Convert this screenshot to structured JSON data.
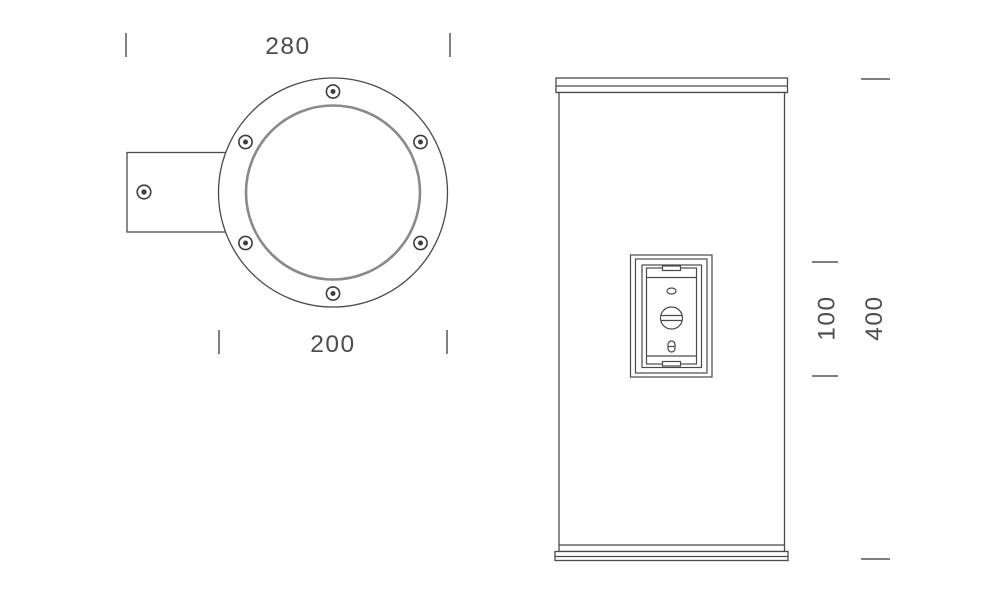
{
  "colors": {
    "background": "#ffffff",
    "outline": "#4a4a4a",
    "glass_ring": "#8a8a8a",
    "dimension": "#555555",
    "text": "#4d4d4d"
  },
  "top_view": {
    "dim_overall_width": "280",
    "dim_flange_diameter": "200",
    "flange_screw_count": 6,
    "bracket_screw_count": 1,
    "icons": {
      "flange_screw": "screw-head-dot",
      "bracket_screw": "screw-head-dot"
    }
  },
  "side_view": {
    "dim_panel_height": "100",
    "dim_body_length": "400",
    "icons": {
      "panel_slot": "oval-slot",
      "panel_screw": "slotted-screw-head",
      "panel_keyhole": "keyhole-slot"
    }
  }
}
